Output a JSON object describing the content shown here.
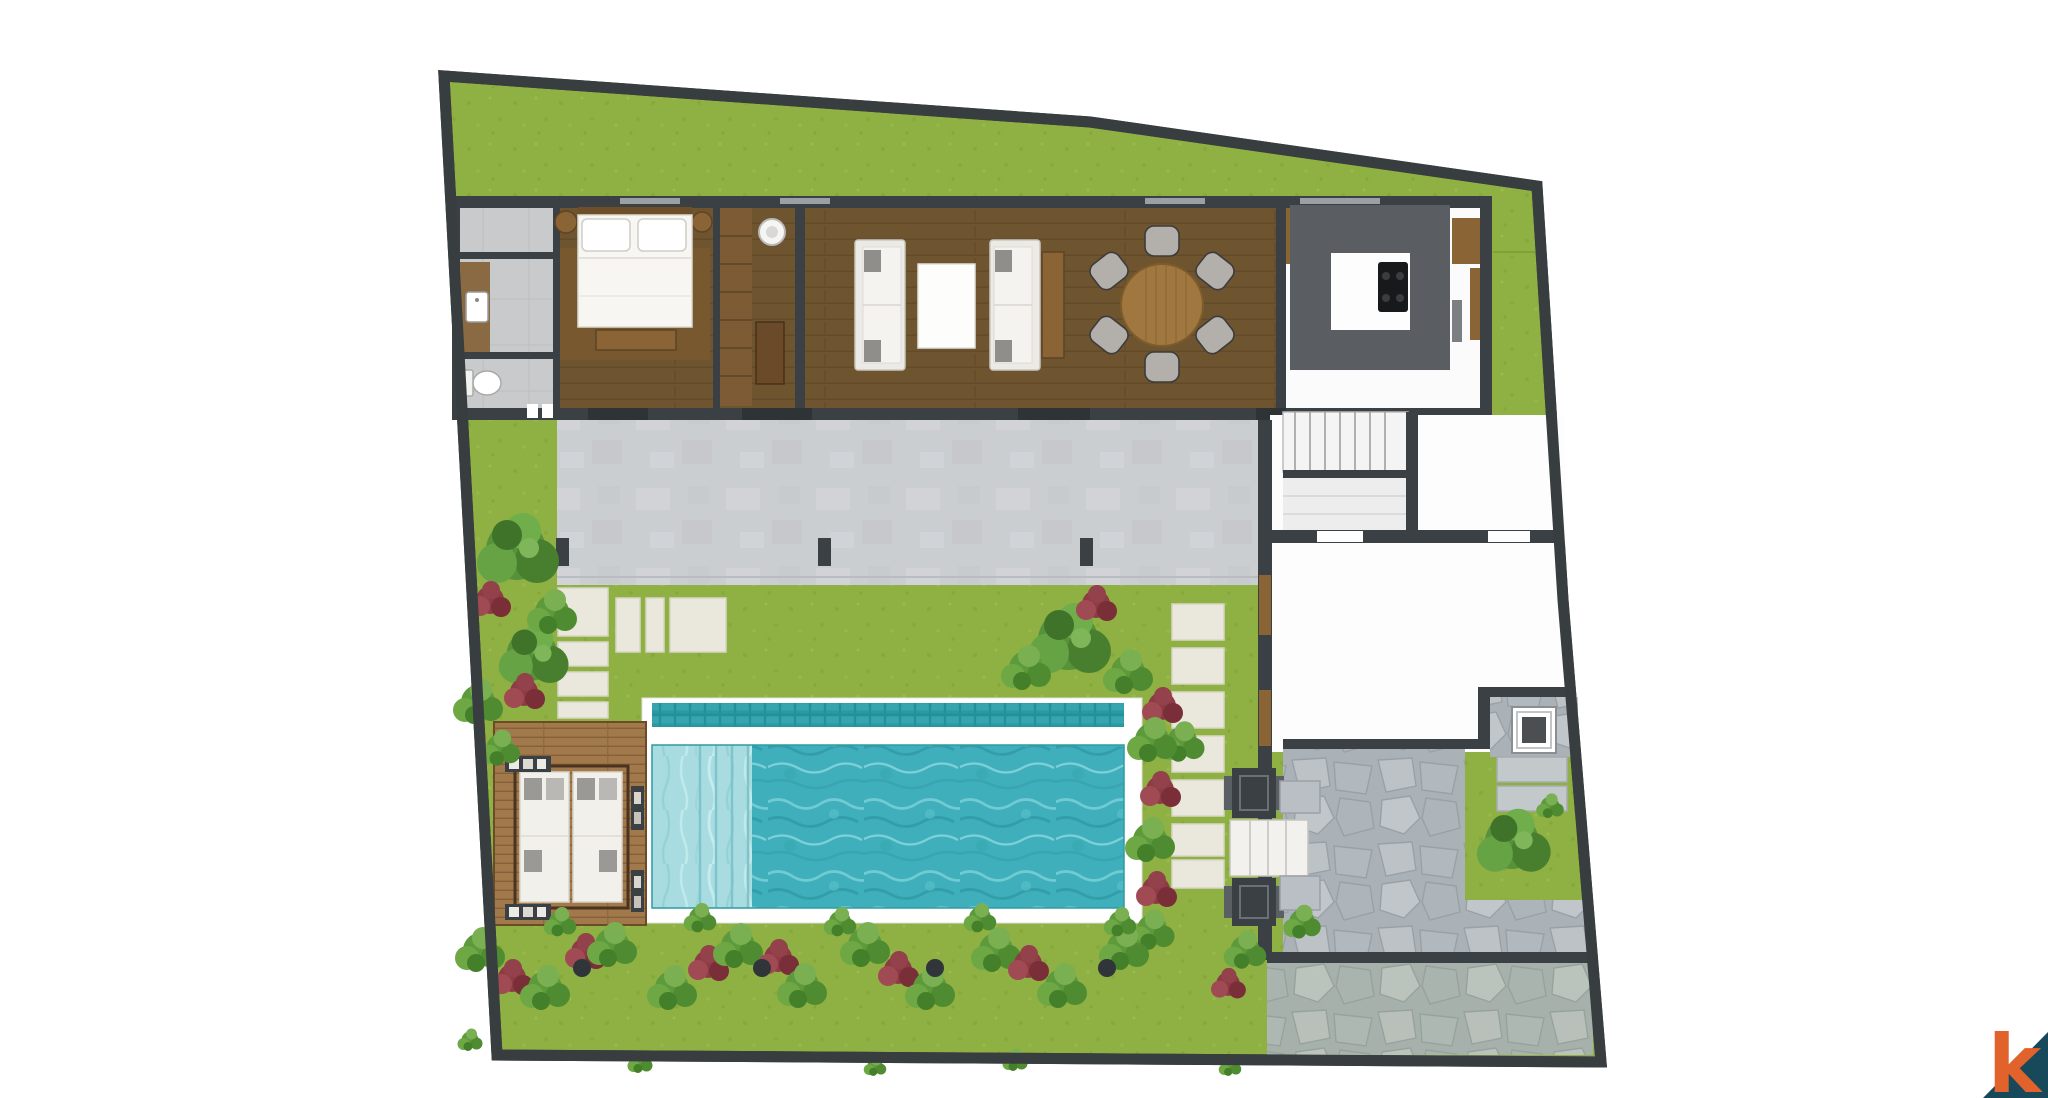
{
  "document": {
    "type": "architectural floor plan",
    "style": "top-down 2D colour render",
    "subject": "single-storey villa with garden, timber deck and lap pool"
  },
  "logo": {
    "letter": "k",
    "letter_color": "#E2622B",
    "triangle_color": "#17495A"
  },
  "palette": {
    "background": "#FFFFFF",
    "lawn": "#8FB042",
    "boundary_wall": "#3A4043",
    "wood_floor": "#6F5430",
    "deck_wood": "#A2794A",
    "terrace_concrete": "#CBCED1",
    "pool_water": "#3FB0BB",
    "pool_shallow": "#A8DCE0",
    "pool_gutter_tile": "#2B97A1",
    "flagstone": "#B6BDC2",
    "stepping_stone": "#E9E7DC",
    "kitchen_counter": "#5A5E62",
    "foliage_green": "#5D9A3B",
    "foliage_red": "#8E3B45"
  },
  "rooms": [
    {
      "name": "bathroom",
      "features": [
        "timber vanity with white sink",
        "toilet",
        "grey tile floor"
      ]
    },
    {
      "name": "bedroom",
      "features": [
        "double bed with two pillows",
        "foot bench",
        "two round bedside tables",
        "area rug"
      ]
    },
    {
      "name": "walk-in wardrobe",
      "features": [
        "shelving unit",
        "round mirror",
        "low cabinet"
      ]
    },
    {
      "name": "living room",
      "features": [
        "two facing sofas",
        "white coffee table",
        "timber side console"
      ]
    },
    {
      "name": "dining area",
      "features": [
        "round timber table",
        "six grey chairs"
      ]
    },
    {
      "name": "kitchen",
      "features": [
        "dark U-shaped counter",
        "four-burner stove",
        "timber cabinets"
      ]
    },
    {
      "name": "staircase",
      "features": [
        "straight flight of treads with landing"
      ]
    },
    {
      "name": "store / garage room",
      "features": [
        "white floor",
        "timber doors to pool court"
      ]
    }
  ],
  "outdoor": {
    "terrace": "long concrete slab along the house with three dark posts",
    "pool": {
      "water": "turquoise lap pool",
      "shallow_ledge": "pale shallow entry with steps at left end",
      "overflow_gutter": "dark teal tile band along the top edge",
      "coping": "white surround"
    },
    "deck": {
      "material": "timber planks",
      "furniture": [
        "double sun lounger with white cushions and grey pillows",
        "four dark side tables"
      ]
    },
    "paths": "cream stepping-stone pads from terrace to deck and along the pool end",
    "entrance_gate": {
      "pillars": 2,
      "steps": "white entry steps between dark pillars"
    },
    "stone_court": "irregular grey flagstone paving at the entrance court",
    "water_feature": "square fountain basin on a stone pad in the corner",
    "planting": [
      "perimeter bed of green shrubs and red cordylines along the pool",
      "tree clusters on the left lawn",
      "corner lawn patch with tree near the entrance"
    ],
    "ground_lights": 4
  },
  "site": {
    "boundary": "dark perimeter wall, irregular quadrilateral plot",
    "lawn": "bright green lawn wrapping the top, left and right of the house"
  }
}
